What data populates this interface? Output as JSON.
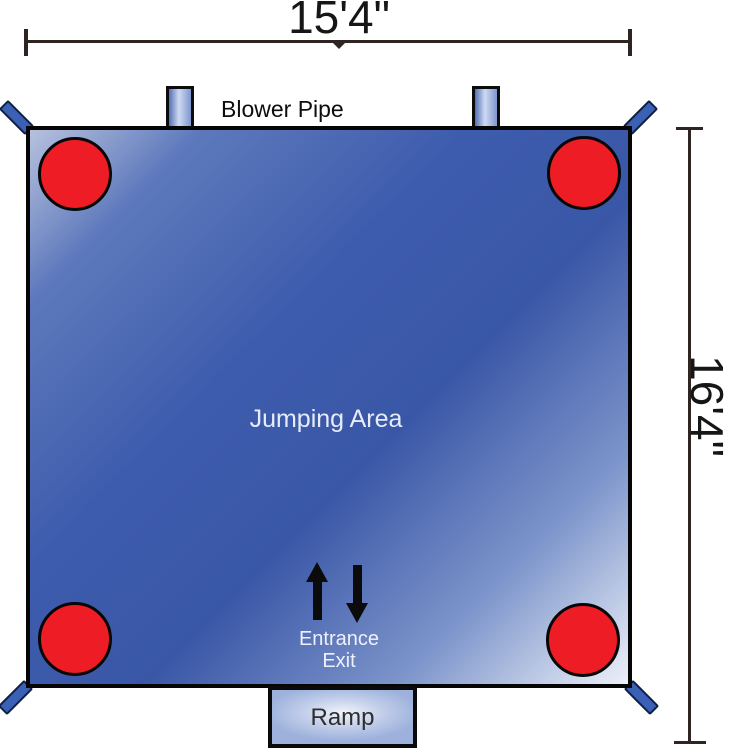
{
  "diagram": {
    "type": "bounce-house-floor-plan",
    "dimensions": {
      "width": "15'4\"",
      "height": "16'4\""
    },
    "labels": {
      "blower_pipe": "Blower Pipe",
      "jumping_area": "Jumping Area",
      "entrance": "Entrance",
      "exit": "Exit",
      "ramp": "Ramp"
    },
    "icons": {
      "entrance_arrow": "arrow-up",
      "exit_arrow": "arrow-down",
      "anchor_points": "red-circle",
      "corner_straps": "blue-diagonal-strap"
    },
    "counts": {
      "anchor_points": 4,
      "blower_pipes": 2,
      "corner_straps": 4
    },
    "colors": {
      "mat_dark_blue": "#3a57a7",
      "mat_light_blue": "#b7c1de",
      "mat_highlight": "#ecf0f8",
      "anchor_red": "#ee1c25",
      "strap_blue": "#3a61b5",
      "pipe_light": "#cfdaf1",
      "outline_black": "#050505",
      "dimension_line": "#2e2522",
      "light_text": "#e7ecf9",
      "dark_text": "#161616"
    }
  }
}
